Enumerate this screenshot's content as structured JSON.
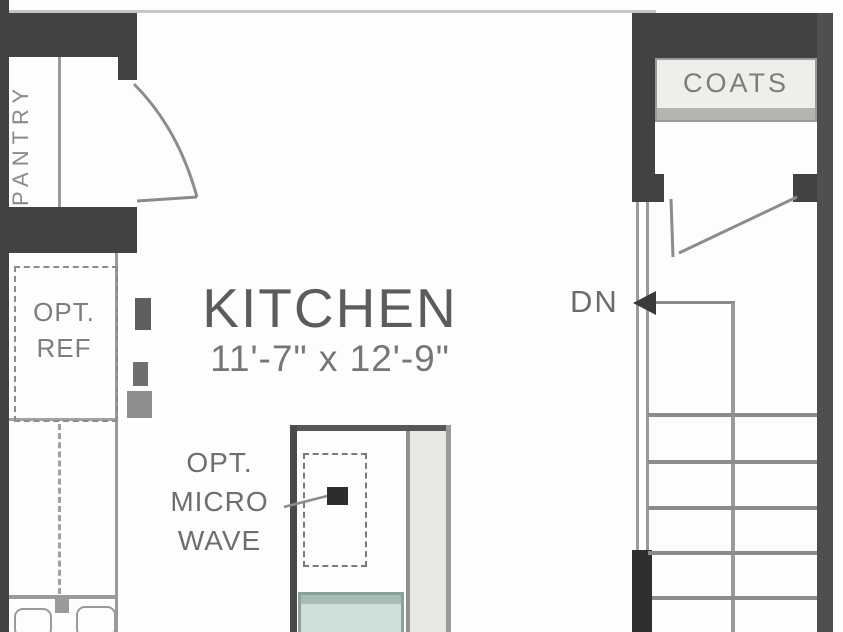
{
  "labels": {
    "kitchen": {
      "name": "KITCHEN",
      "dimensions": "11'-7\" x 12'-9\""
    },
    "pantry": {
      "name": "PANTRY"
    },
    "coats": {
      "name": "COATS"
    },
    "optional_refrigerator": {
      "line1": "OPT.",
      "line2": "REF"
    },
    "optional_microwave": {
      "line1": "OPT.",
      "line2": "MICRO",
      "line3": "WAVE"
    },
    "stairs": {
      "direction": "DN"
    }
  },
  "colors": {
    "wall": "#424242",
    "wall_dark": "#2f2f2f",
    "wall_right": "#4f4f4f",
    "line": "#8c8c8c",
    "line_mid": "#9a9a9a",
    "line_light": "#c6c6c6",
    "text": "#6e6e6e",
    "text_dark": "#5c5c5c",
    "sink_border": "#8aa29b",
    "sink_fill": "#cfe0d9",
    "sink_band": "#a9bcb4",
    "shelf_fill": "#efeeea",
    "island_strip": "#e6e8e4",
    "dot": "#2d2d2d",
    "paper": "#fdfdfc"
  }
}
